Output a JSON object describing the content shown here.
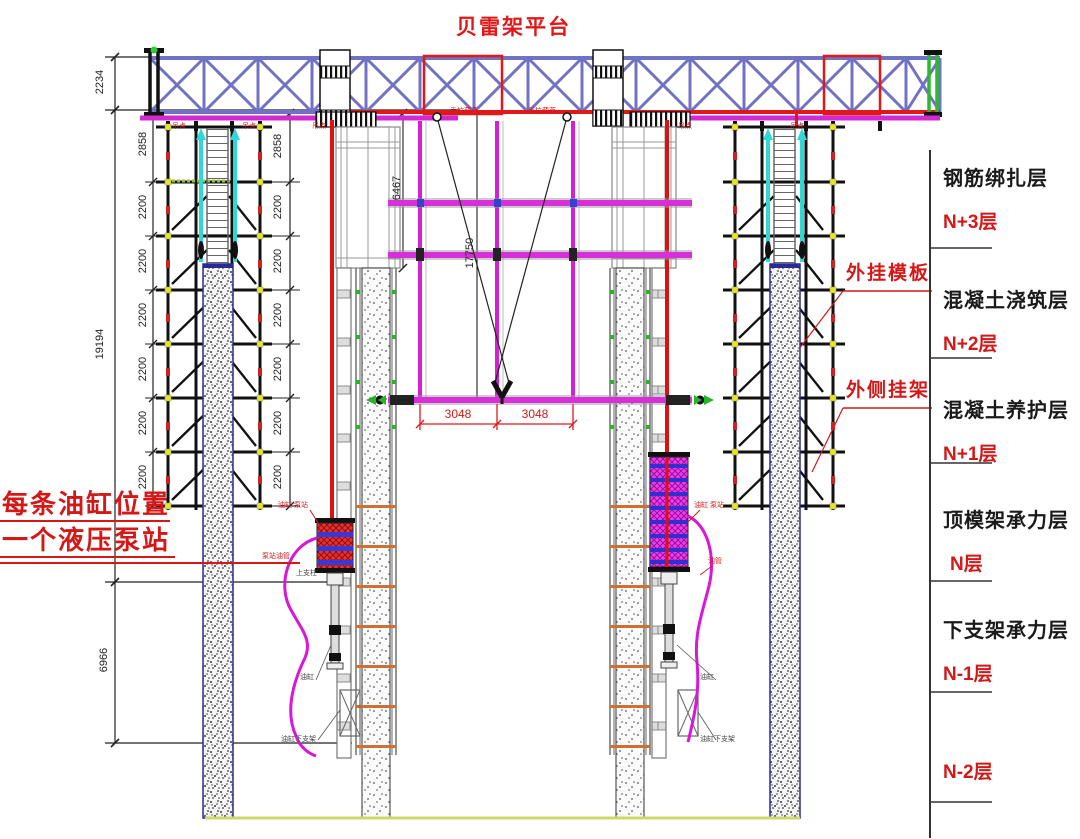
{
  "title": {
    "text": "贝雷架平台"
  },
  "legend": {
    "items": [
      {
        "label": "钢筋绑扎层",
        "level": "N+3层"
      },
      {
        "label": "混凝土浇筑层",
        "level": "N+2层"
      },
      {
        "label": "混凝土养护层",
        "level": "N+1层"
      },
      {
        "label": "顶模架承力层",
        "level": "N层"
      },
      {
        "label": "下支架承力层",
        "level": "N-1层"
      },
      {
        "label": "",
        "level": "N-2层"
      }
    ]
  },
  "callouts": {
    "formwork": "外挂模板",
    "outer_hanger": "外侧挂架",
    "note_line1": "每条油缸位置",
    "note_line2": "一个液压泵站",
    "hoist": "手拉葫芦",
    "lift_point": "吊点",
    "cylinder_pump": "油缸 泵站",
    "pump_hose": "泵站油管",
    "upper_post": "上支柱",
    "cylinder": "油缸",
    "cylinder_bracket": "油缸下支架",
    "oil_hose": "油管"
  },
  "dimensions": {
    "top_height": "2234",
    "overall": "19194",
    "lower": "6966",
    "upper_bay": "2858",
    "bay": "2200",
    "rail_upper": "6467",
    "rail_total": "17750",
    "platform_bay": "3048"
  },
  "colors": {
    "truss_blue": "#7272c4",
    "accent_red": "#e01818",
    "magenta": "#d428d4",
    "cyan": "#2fd8d8",
    "node_yellow": "#e6e620",
    "green": "#28b428",
    "ground_yellow": "#cbd96a"
  }
}
